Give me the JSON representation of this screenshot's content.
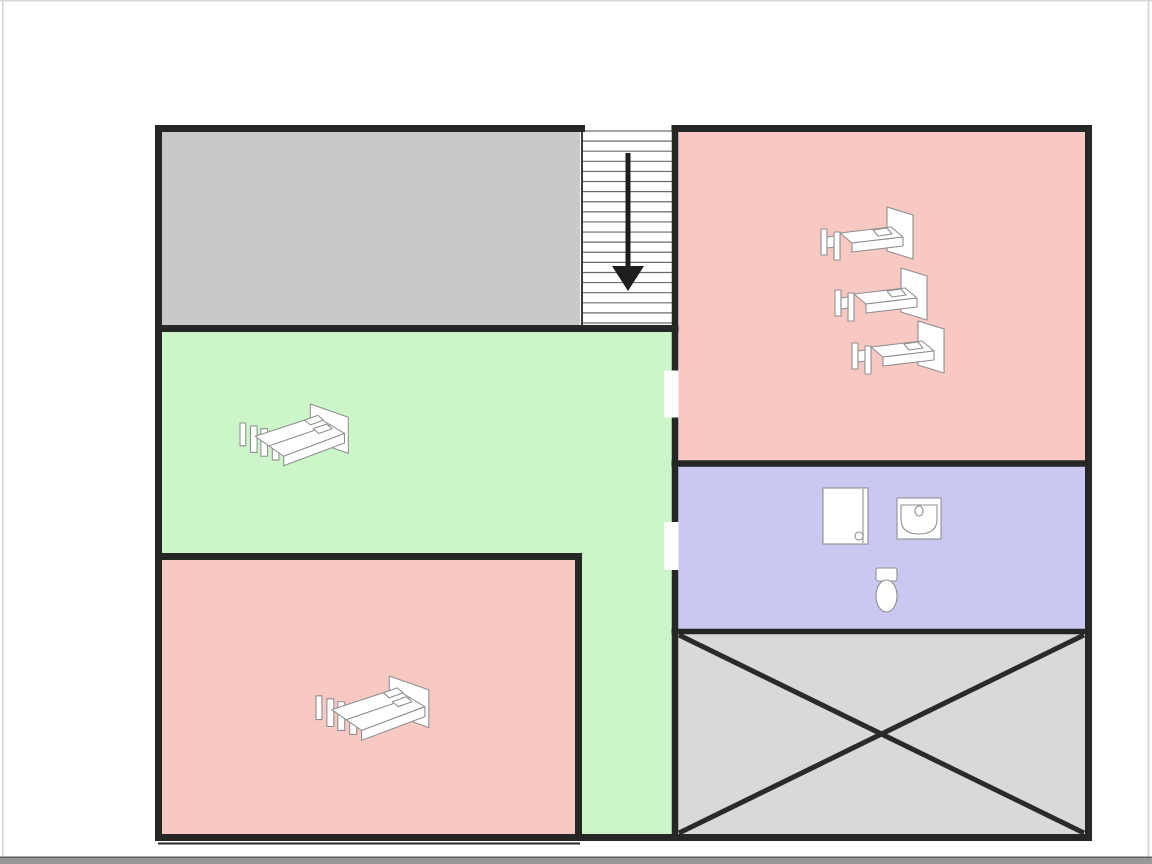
{
  "floorplan": {
    "background": "#ffffff",
    "wall_color": "#262626",
    "furniture_outline": "#8f8f8f",
    "furniture_fill": "#ffffff",
    "door_fill": "#fdfdfd",
    "frame": {
      "top_edge_color": "#d6d6d6",
      "side_edge_color": "#d6d6d6",
      "bottom_bar_color": "#979797",
      "bottom_bar_edge_color": "#5f5f5f"
    },
    "rooms": {
      "gray_room": {
        "fill": "#c9c9c9",
        "furniture_count": 0
      },
      "stairwell": {
        "fill": "#ffffff",
        "steps": 20,
        "direction": "down",
        "step_line_color": "#6a6a6a",
        "arrow_color": "#1e1e1e",
        "icon": "stairs-down-arrow-icon"
      },
      "bedroom_top_right": {
        "fill": "#f8c8c3",
        "beds": 3,
        "bed_icon": "single-bed-icon"
      },
      "bedroom_green": {
        "fill": "#ccf5ca",
        "beds": 1,
        "bed_icon": "double-bed-icon"
      },
      "bedroom_bottom_left": {
        "fill": "#f8c8c3",
        "beds": 1,
        "bed_icon": "double-bed-icon"
      },
      "bathroom": {
        "fill": "#cac8f1",
        "fixtures": [
          "shower-icon",
          "sink-icon",
          "toilet-icon"
        ]
      },
      "void_area": {
        "fill": "#d9d9d9",
        "marking": "diagonal-cross",
        "marking_color": "#2a2a2a"
      }
    },
    "door_count": 2
  }
}
